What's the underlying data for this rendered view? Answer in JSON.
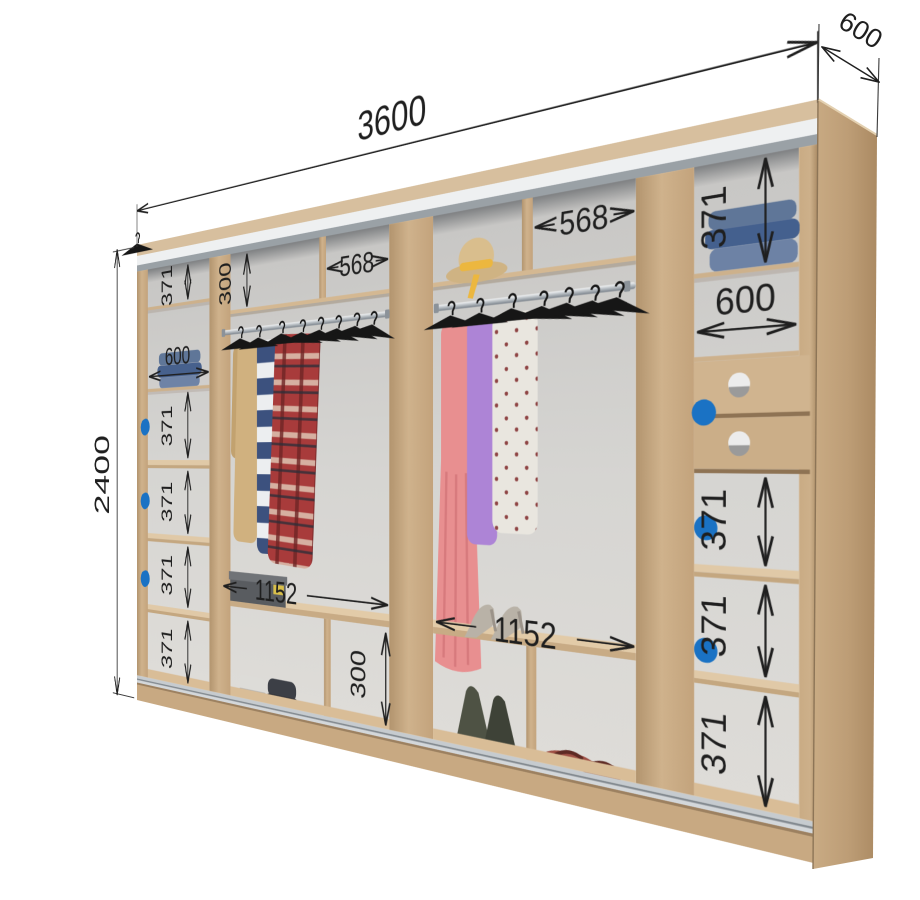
{
  "dims": {
    "overall_width": "3600",
    "overall_height": "2400",
    "overall_depth": "600",
    "left_column": [
      "371",
      "600",
      "371",
      "371",
      "371",
      "371"
    ],
    "top_shelf_left": {
      "height": "300",
      "width": "568"
    },
    "top_shelf_right": {
      "width": "568"
    },
    "hanging_left_width": "1152",
    "hanging_right_width": "1152",
    "shoe_compartment_height": "300",
    "right_column": [
      "371",
      "600",
      "371",
      "371",
      "371"
    ]
  },
  "colors": {
    "wood": "#cdb18c",
    "wood_light": "#dfc7a4",
    "wood_dark": "#b3946f",
    "back_wall": "#d3d2cf",
    "front_trim_white": "#eef0f1",
    "front_trim_gray": "#9aa1a6",
    "track_silver": "#c6cbcf",
    "dimension": "#1f1f1f",
    "hook_blue": "#1a72c4",
    "hanger_black": "#161616"
  }
}
